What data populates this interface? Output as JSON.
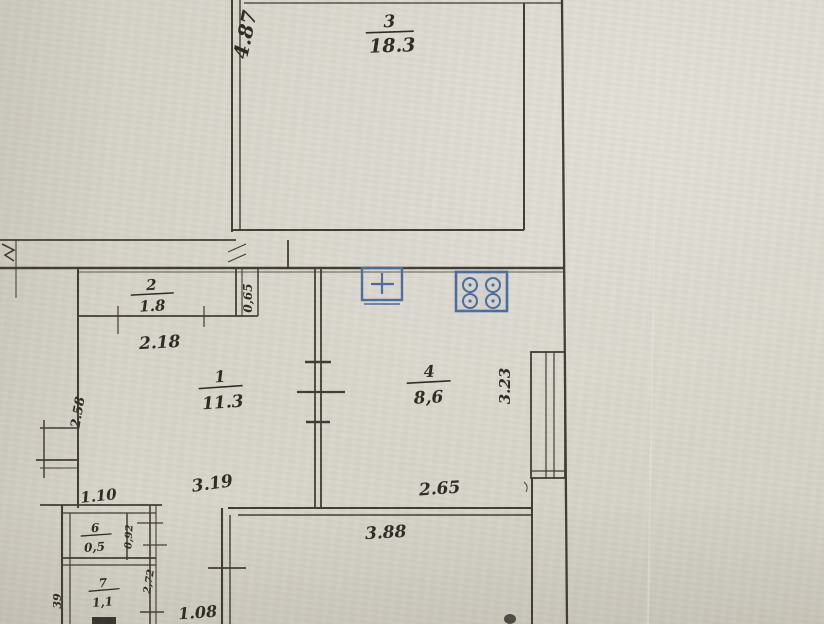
{
  "document": {
    "kind": "hand-drawn apartment floor plan (photograph of paper document)",
    "paper_color": "#d6d3c9",
    "ink_color": "#3e3a32",
    "stamp_color": "#4a6b9d"
  },
  "rooms": {
    "r3": {
      "number": "3",
      "area": "18.3"
    },
    "r2": {
      "number": "2",
      "area": "1.8"
    },
    "r1": {
      "number": "1",
      "area": "11.3"
    },
    "r4": {
      "number": "4",
      "area": "8,6"
    },
    "r6": {
      "number": "6",
      "area": "0,5"
    },
    "r7": {
      "number": "7",
      "area": "1,1"
    }
  },
  "dimensions": {
    "room3_depth": "4.87",
    "closet_width": "2.18",
    "closet_niche_depth": "0,65",
    "room1_width": "3.19",
    "room1_left_wall": "2.58",
    "niche_width": "1.10",
    "kitchen_width": "2.65",
    "kitchen_depth": "3.23",
    "lower_room_width": "3.88",
    "lower_left_offset": "1.08",
    "small_room_depth": "0,92",
    "hall_depth": "2,72",
    "edge_partial": "39"
  },
  "fixtures": {
    "sink": "sink-symbol (square with cross)",
    "stove": "stove-symbol (4 burners)"
  }
}
